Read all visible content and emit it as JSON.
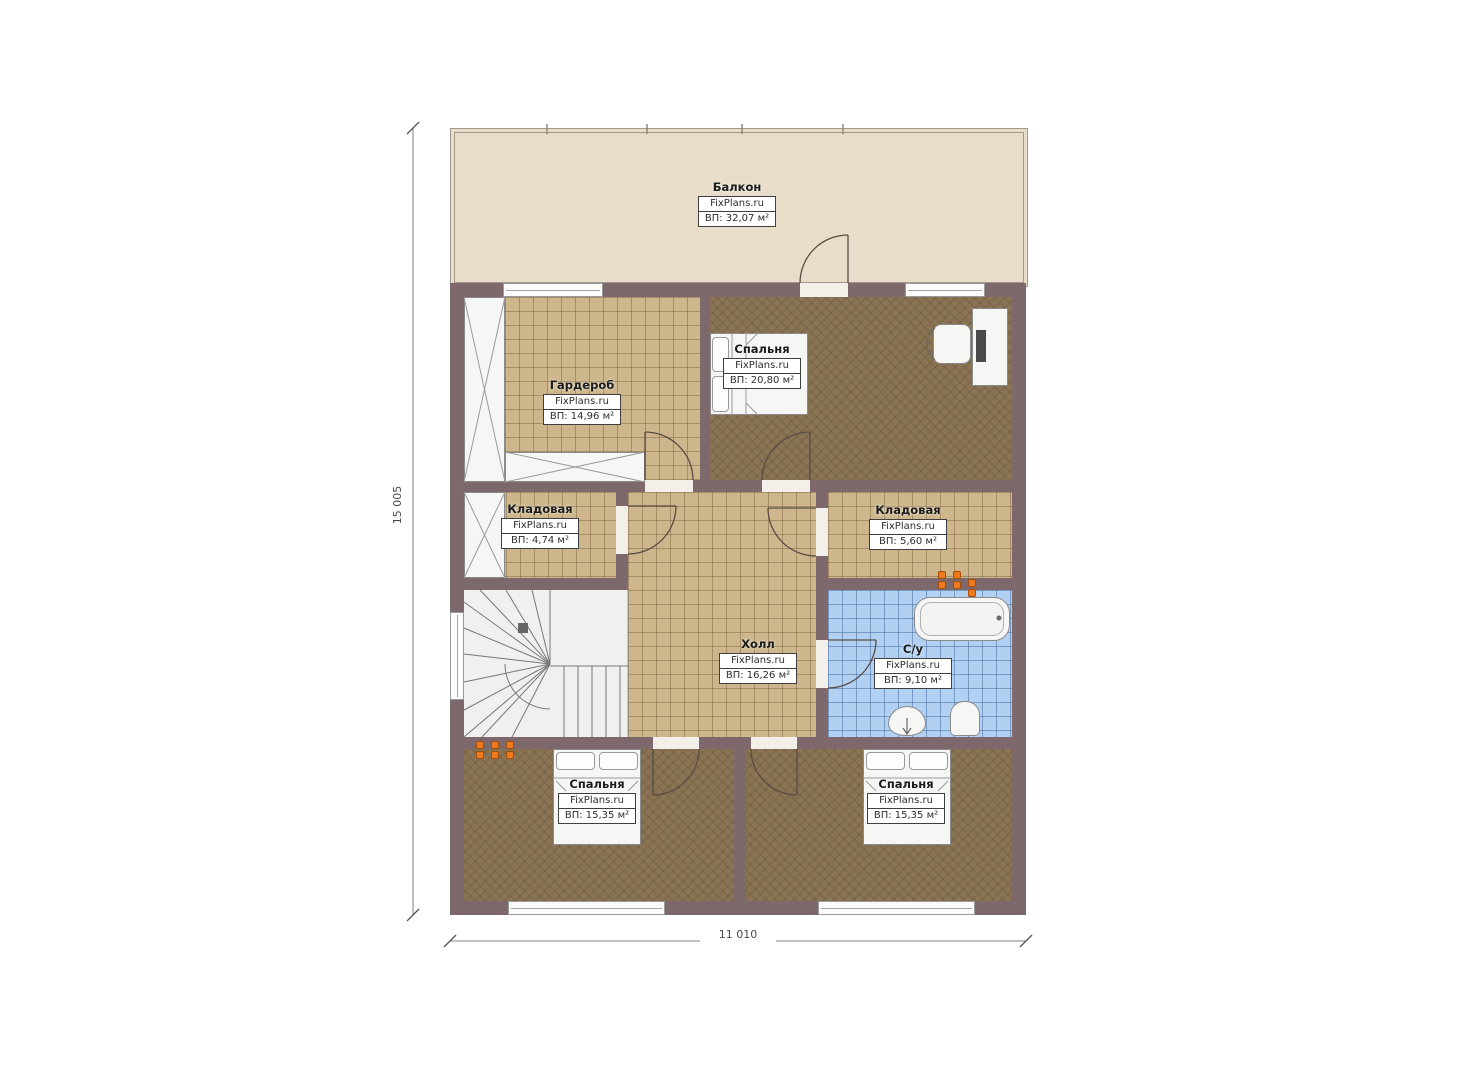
{
  "plan": {
    "type": "floor-plan",
    "watermark": "FixPlans.ru",
    "rooms": [
      {
        "key": "balcony",
        "name": "Балкон",
        "watermark": "FixPlans.ru",
        "area": "ВП: 32,07 м²"
      },
      {
        "key": "wardrobe",
        "name": "Гардероб",
        "watermark": "FixPlans.ru",
        "area": "ВП: 14,96 м²"
      },
      {
        "key": "bedroom-top",
        "name": "Спальня",
        "watermark": "FixPlans.ru",
        "area": "ВП: 20,80 м²"
      },
      {
        "key": "storage-left",
        "name": "Кладовая",
        "watermark": "FixPlans.ru",
        "area": "ВП: 4,74 м²"
      },
      {
        "key": "storage-right",
        "name": "Кладовая",
        "watermark": "FixPlans.ru",
        "area": "ВП: 5,60 м²"
      },
      {
        "key": "hall",
        "name": "Холл",
        "watermark": "FixPlans.ru",
        "area": "ВП: 16,26 м²"
      },
      {
        "key": "bathroom",
        "name": "С/у",
        "watermark": "FixPlans.ru",
        "area": "ВП: 9,10 м²"
      },
      {
        "key": "bedroom-left",
        "name": "Спальня",
        "watermark": "FixPlans.ru",
        "area": "ВП: 15,35 м²"
      },
      {
        "key": "bedroom-right",
        "name": "Спальня",
        "watermark": "FixPlans.ru",
        "area": "ВП: 15,35 м²"
      }
    ],
    "dimensions": {
      "height": "15 005",
      "width": "11 010"
    },
    "colors": {
      "wall": "#7d686b",
      "tile_floor": "#cdb68b",
      "carpet_floor": "#8b7454",
      "bath_tile": "#b2d0f2",
      "balcony_floor": "#e8ddc9",
      "outlet_accent": "#ed7a1f"
    }
  }
}
